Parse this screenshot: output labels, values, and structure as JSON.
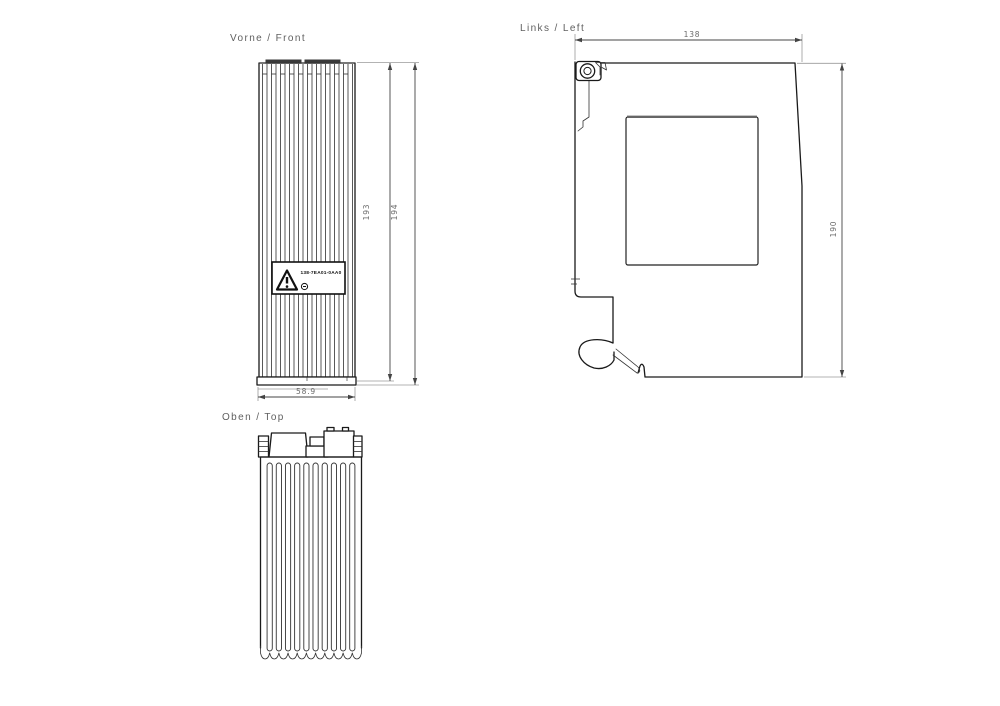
{
  "page": {
    "background": "#ffffff"
  },
  "colors": {
    "line": "#1a1a1a",
    "dimension": "#444444",
    "extension": "#9a9a9a",
    "text": "#5f5f5f",
    "cap": "#3a3a3a"
  },
  "views": {
    "front": {
      "title": "Vorne / Front",
      "dims": {
        "body_height": "193",
        "overall_height": "194",
        "width": "58.9"
      },
      "label": {
        "part_number": "138-7EA01-0AA0",
        "warning_icon": "warning-triangle-icon",
        "cert_icon": "circled-mark-icon"
      }
    },
    "left": {
      "title": "Links / Left",
      "dims": {
        "depth": "138",
        "height": "190"
      }
    },
    "top": {
      "title": "Oben / Top"
    }
  }
}
